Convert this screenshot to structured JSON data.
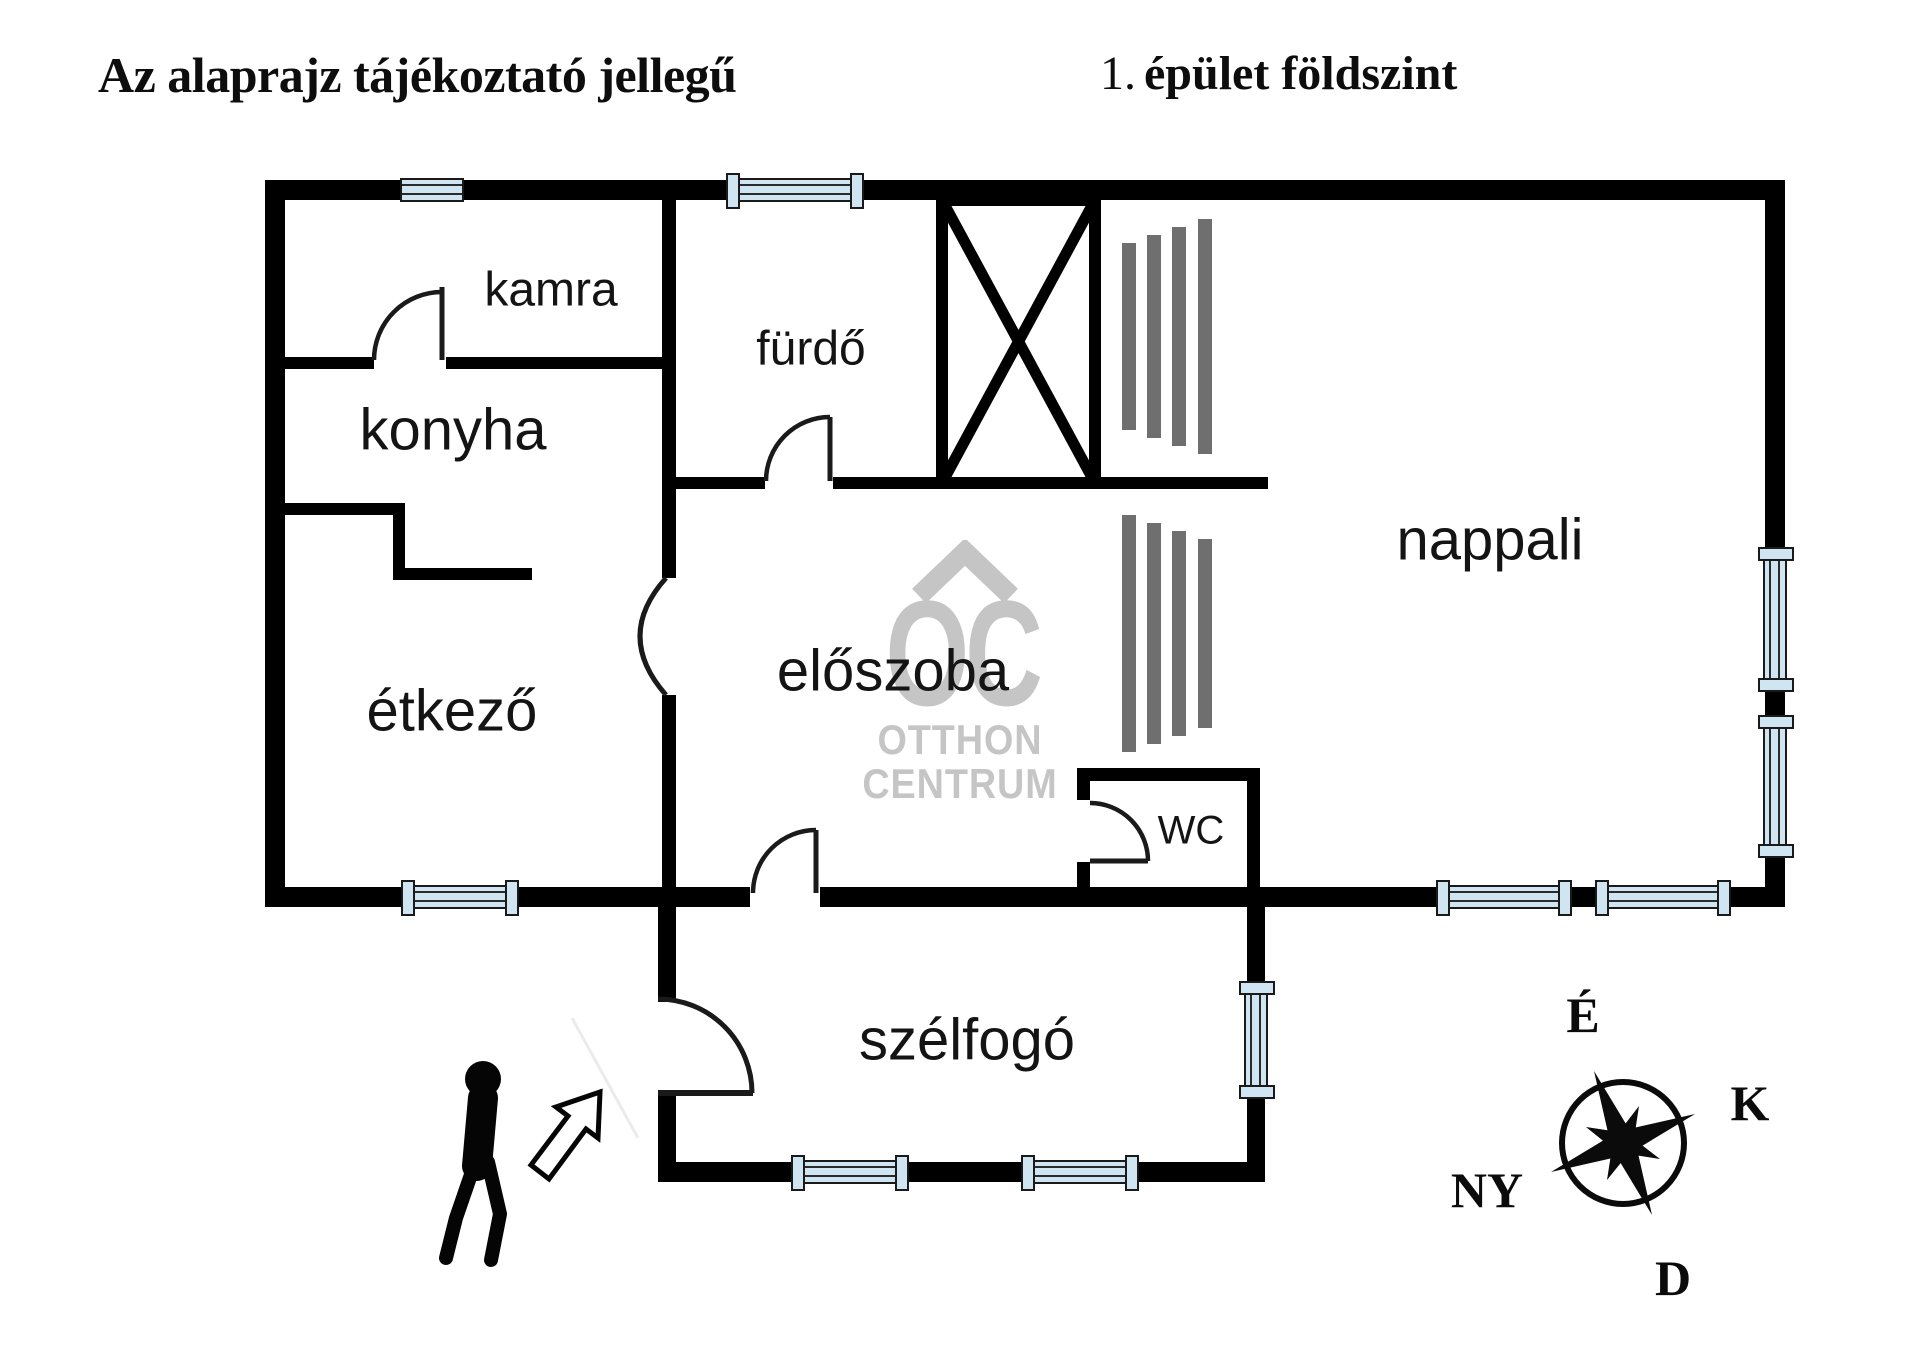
{
  "header": {
    "disclaimer": "Az alaprajz tájékoztató jellegű",
    "floor_prefix": "1.",
    "floor_title": "épület földszint"
  },
  "rooms": {
    "kamra": "kamra",
    "furdo": "fürdő",
    "konyha": "konyha",
    "etkezo": "étkező",
    "eloszoba": "előszoba",
    "nappali": "nappali",
    "wc": "WC",
    "szelfogo": "szélfogó"
  },
  "watermark": {
    "logo": "OC",
    "line1": "OTTHON",
    "line2": "CENTRUM"
  },
  "compass": {
    "north": "É",
    "east": "K",
    "south": "D",
    "west": "NY"
  },
  "colors": {
    "wall": "#000000",
    "window_fill": "#cfe5f1",
    "window_frame": "#1a1a1a",
    "stairs_gray": "#6f6f6f",
    "watermark_gray": "#c5c5c5"
  }
}
